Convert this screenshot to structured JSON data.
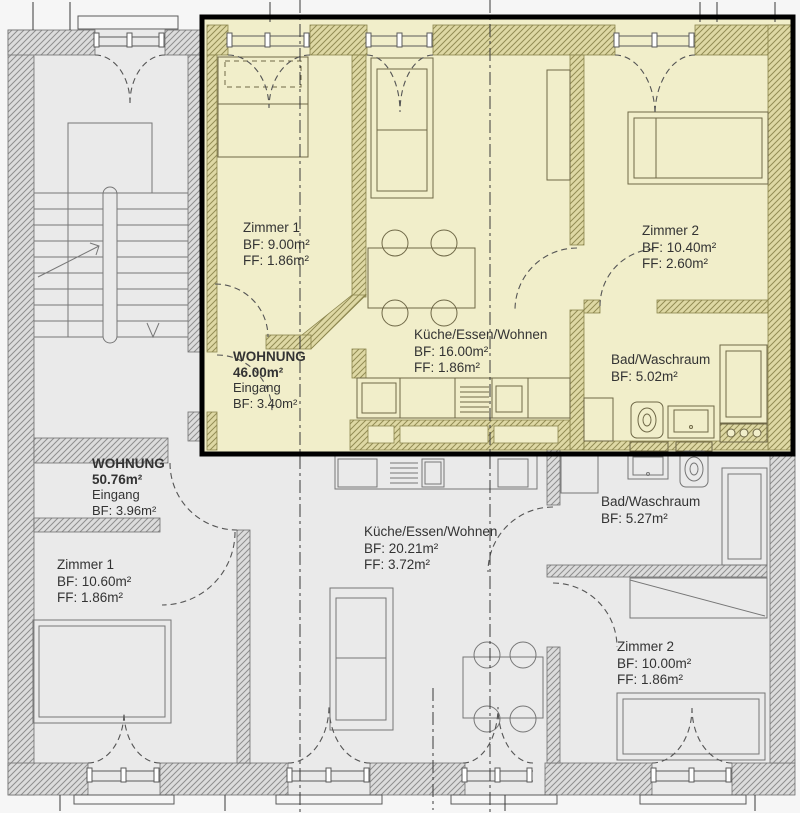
{
  "drawing": {
    "type": "floorplan",
    "language": "de",
    "highlighted_apartment": "WOHNUNG 46.00m²"
  },
  "colors": {
    "highlight_fill": "#f1eeca",
    "highlight_border": "#000000",
    "wall_fill_gray": "#dcdcdc",
    "wall_line_gray": "#8f8f8f",
    "wall_fill_highlight": "#ded8a4",
    "wall_line_highlight": "#938d55",
    "floor_gray": "#eaeaea",
    "line": "#6a6a6a",
    "text": "#333333"
  },
  "apartments": [
    {
      "name": "WOHNUNG",
      "area": "46.00m²",
      "entry": "Eingang",
      "entry_bf": "BF: 3.40m²",
      "rooms": [
        {
          "name": "Zimmer 1",
          "bf": "BF: 9.00m²",
          "ff": "FF: 1.86m²"
        },
        {
          "name": "Küche/Essen/Wohnen",
          "bf": "BF: 16.00m²",
          "ff": "FF: 1.86m²"
        },
        {
          "name": "Zimmer 2",
          "bf": "BF: 10.40m²",
          "ff": "FF: 2.60m²"
        },
        {
          "name": "Bad/Waschraum",
          "bf": "BF: 5.02m²"
        }
      ]
    },
    {
      "name": "WOHNUNG",
      "area": "50.76m²",
      "entry": "Eingang",
      "entry_bf": "BF: 3.96m²",
      "rooms": [
        {
          "name": "Zimmer 1",
          "bf": "BF: 10.60m²",
          "ff": "FF: 1.86m²"
        },
        {
          "name": "Küche/Essen/Wohnen",
          "bf": "BF: 20.21m²",
          "ff": "FF: 3.72m²"
        },
        {
          "name": "Bad/Waschraum",
          "bf": "BF: 5.27m²"
        },
        {
          "name": "Zimmer 2",
          "bf": "BF: 10.00m²",
          "ff": "FF: 1.86m²"
        }
      ]
    }
  ]
}
